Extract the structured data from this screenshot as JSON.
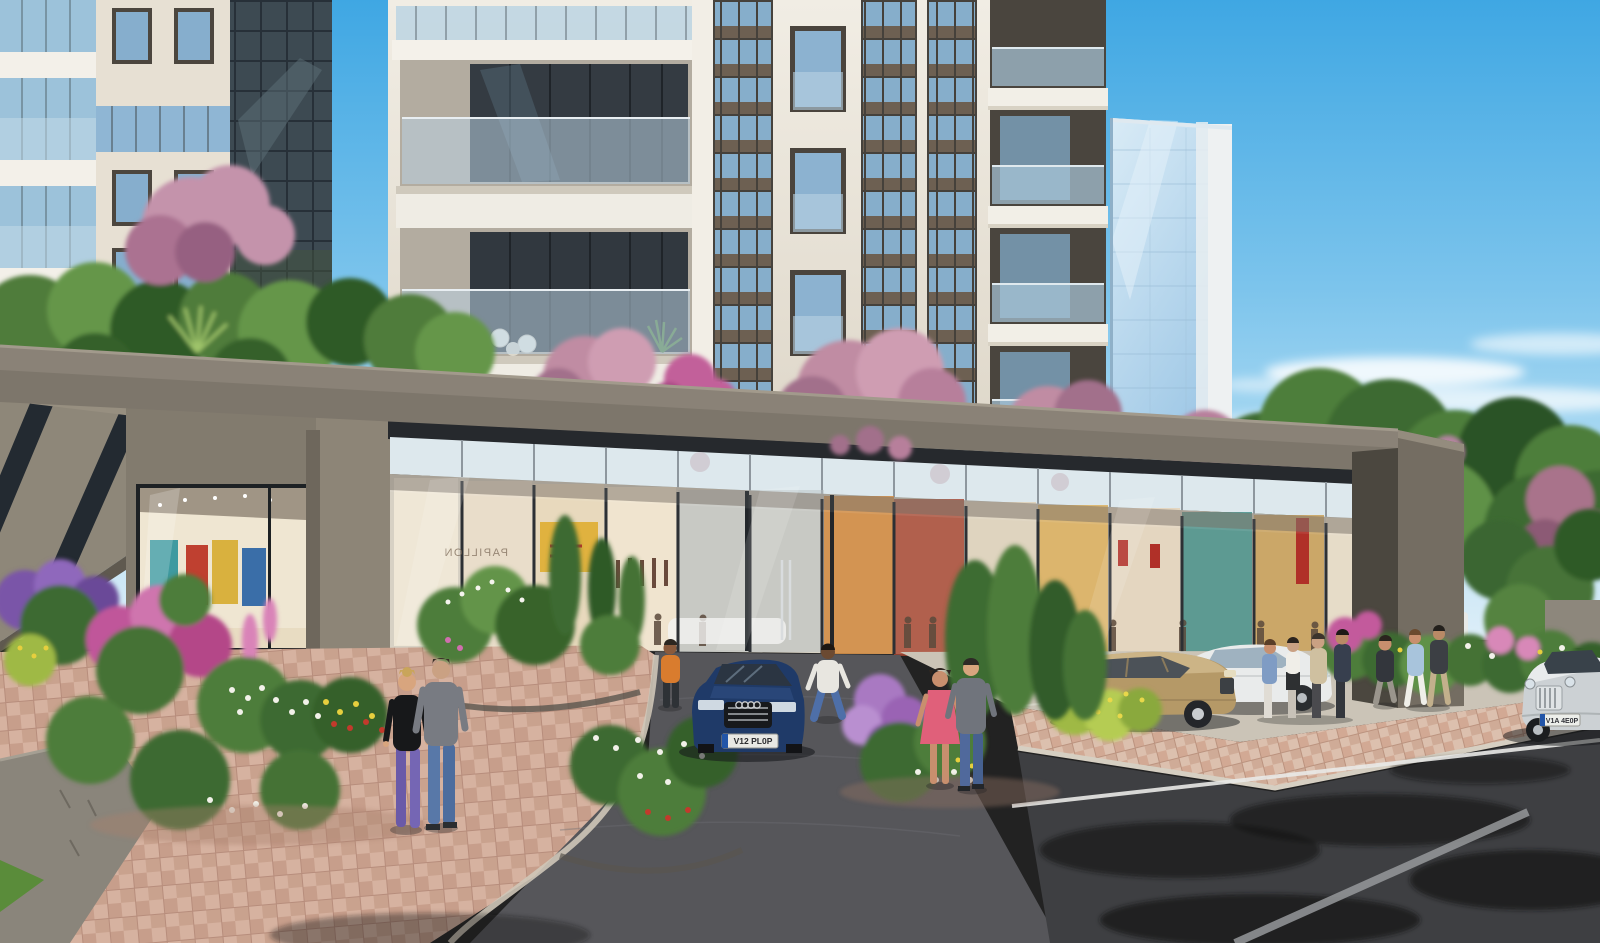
{
  "scene": {
    "title": "Street-level architectural rendering of a modern residential complex with ground-floor retail",
    "style": "photorealistic CGI visualization, sunny day",
    "sky": {
      "description": "clear blue sky with thin white clouds on the right",
      "top_color": "#3fa7e3",
      "horizon_color": "#ddeef8"
    },
    "buildings": {
      "main_tower": "cream high-rise with dark-framed blue glass window strips, Juliet windows and stacked glass-railed balconies",
      "left_tower": "neighboring cream tower with glazed balcony bands and a dark curtain-wall section",
      "glass_tower": "slim light-blue reflective glass tower in the background",
      "podium": "taupe retail podium frame with roof-garden blossom trees and a continuous glazed storefront band"
    },
    "retail": {
      "description": "floor-to-ceiling shop windows with warm-lit clothing displays and mannequins; bright corner boutique on the left",
      "reflected_sign": "PAPILLON"
    },
    "vehicles": [
      {
        "name": "audi-sedan",
        "color": "dark blue",
        "position": "driveway, facing viewer",
        "plate": "V12 PL0P"
      },
      {
        "name": "mercedes-sedan",
        "color": "gold-beige",
        "position": "parked in front of storefront"
      },
      {
        "name": "mercedes-coupe",
        "color": "white",
        "position": "parked beside the gold sedan"
      },
      {
        "name": "hatchback",
        "color": "red",
        "position": "parked far right"
      },
      {
        "name": "van",
        "color": "white",
        "position": "behind the right flower bed"
      },
      {
        "name": "bentley-sedan",
        "color": "silver",
        "position": "driving on the road, lower right",
        "plate": "V1A 4E0P"
      }
    ],
    "people": [
      {
        "name": "couple-viewing-garden",
        "detail": "woman in black top and purple trousers with man in grey top and jeans, backs to viewer on the left walkway"
      },
      {
        "name": "man-orange-shirt",
        "detail": "standing by the left storefront"
      },
      {
        "name": "man-white-tee",
        "detail": "crossing the driveway in jeans"
      },
      {
        "name": "couple-strolling",
        "detail": "woman in pink dress with man in grey sweater, center"
      },
      {
        "name": "shoppers-group",
        "detail": "four pedestrians beside the white coupe"
      },
      {
        "name": "woman-walking",
        "detail": "dark top, right sidewalk"
      },
      {
        "name": "two-pedestrians",
        "detail": "walking along the right flower beds"
      }
    ],
    "landscape": {
      "roof_garden": "pink flowering trees and shrubs on the podium roof terrace",
      "beds": "flower beds with purple, magenta, white, yellow and red blooms along the walkways",
      "hedges": "clipped green shrubs and a lilac bush near the entrance"
    },
    "ground": {
      "walkway": "rose-tan paver sidewalk in basketweave pattern",
      "driveway": "grey block-paved drop-off drive",
      "road": "dark asphalt street with white lane line and tree shadows"
    },
    "palette": {
      "facade_cream": "#ece7df",
      "podium_taupe": "#7d766b",
      "glass_blue": "#8fb6d4",
      "blossom_pink": "#c08ca3",
      "paver_rose": "#d6b2a0",
      "asphalt": "#3e3f42",
      "foliage": "#4e7d3a"
    }
  }
}
